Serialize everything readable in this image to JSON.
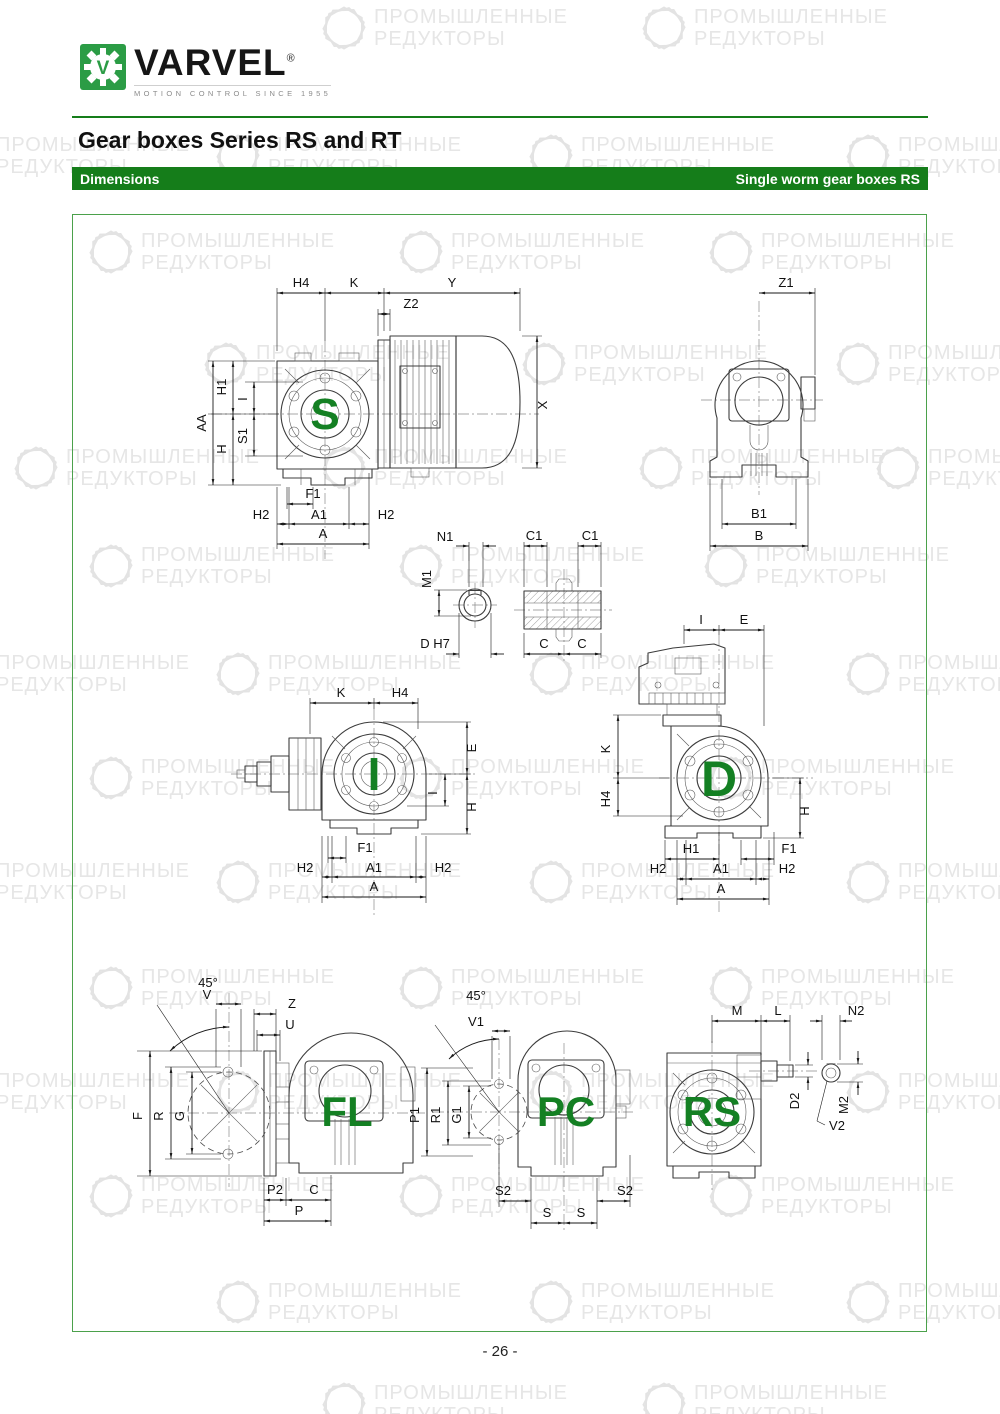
{
  "header": {
    "brand": "VARVEL",
    "brand_reg": "®",
    "logo_monogram": "V",
    "tagline": "MOTION CONTROL SINCE 1955",
    "title": "Gear boxes Series RS and RT",
    "bar_left": "Dimensions",
    "bar_right": "Single worm gear boxes RS"
  },
  "watermark": {
    "line1": "ПРОМЫШЛЕННЫЕ",
    "line2": "РЕДУКТОРЫ"
  },
  "footer": {
    "page_number": "- 26 -"
  },
  "colors": {
    "accent_green": "#157d1a",
    "letter_green": "#148023",
    "logo_green": "#2b9c45",
    "watermark_gray": "#e6e6e6"
  },
  "drawings": {
    "s": {
      "letter": "S",
      "dims": {
        "h4": "H4",
        "k": "K",
        "y": "Y",
        "z2": "Z2",
        "x": "X",
        "aa": "AA",
        "h1": "H1",
        "i": "I",
        "h": "H",
        "s1": "S1",
        "f1": "F1",
        "h2l": "H2",
        "a1": "A1",
        "h2r": "H2",
        "a": "A"
      }
    },
    "b": {
      "dims": {
        "z1": "Z1",
        "b1": "B1",
        "b": "B"
      }
    },
    "bore": {
      "dims": {
        "n1": "N1",
        "m1": "M1",
        "dh7": "D H7"
      }
    },
    "hollow": {
      "dims": {
        "c1l": "C1",
        "c1r": "C1",
        "cl": "C",
        "cr": "C"
      }
    },
    "i": {
      "letter": "I",
      "dims": {
        "k": "K",
        "h4": "H4",
        "e": "E",
        "i": "I",
        "h": "H",
        "f1": "F1",
        "h2l": "H2",
        "a1": "A1",
        "h2r": "H2",
        "a": "A"
      }
    },
    "d": {
      "letter": "D",
      "dims": {
        "i": "I",
        "e": "E",
        "k": "K",
        "h4": "H4",
        "h": "H",
        "h1": "H1",
        "f1": "F1",
        "h2l": "H2",
        "a1": "A1",
        "h2r": "H2",
        "a": "A"
      }
    },
    "fl": {
      "letter": "FL",
      "dims": {
        "angle": "45°",
        "v": "V",
        "z": "Z",
        "u": "U",
        "f": "F",
        "r": "R",
        "g": "G",
        "p2": "P2",
        "c": "C",
        "p": "P"
      }
    },
    "pc": {
      "letter": "PC",
      "dims": {
        "angle": "45°",
        "v1": "V1",
        "p1": "P1",
        "r1": "R1",
        "g1": "G1",
        "s2l": "S2",
        "sl": "S",
        "sr": "S",
        "s2r": "S2"
      }
    },
    "rs": {
      "letter": "RS",
      "dims": {
        "m": "M",
        "l": "L",
        "n2": "N2",
        "d2": "D2",
        "m2": "M2",
        "v2": "V2"
      }
    }
  }
}
